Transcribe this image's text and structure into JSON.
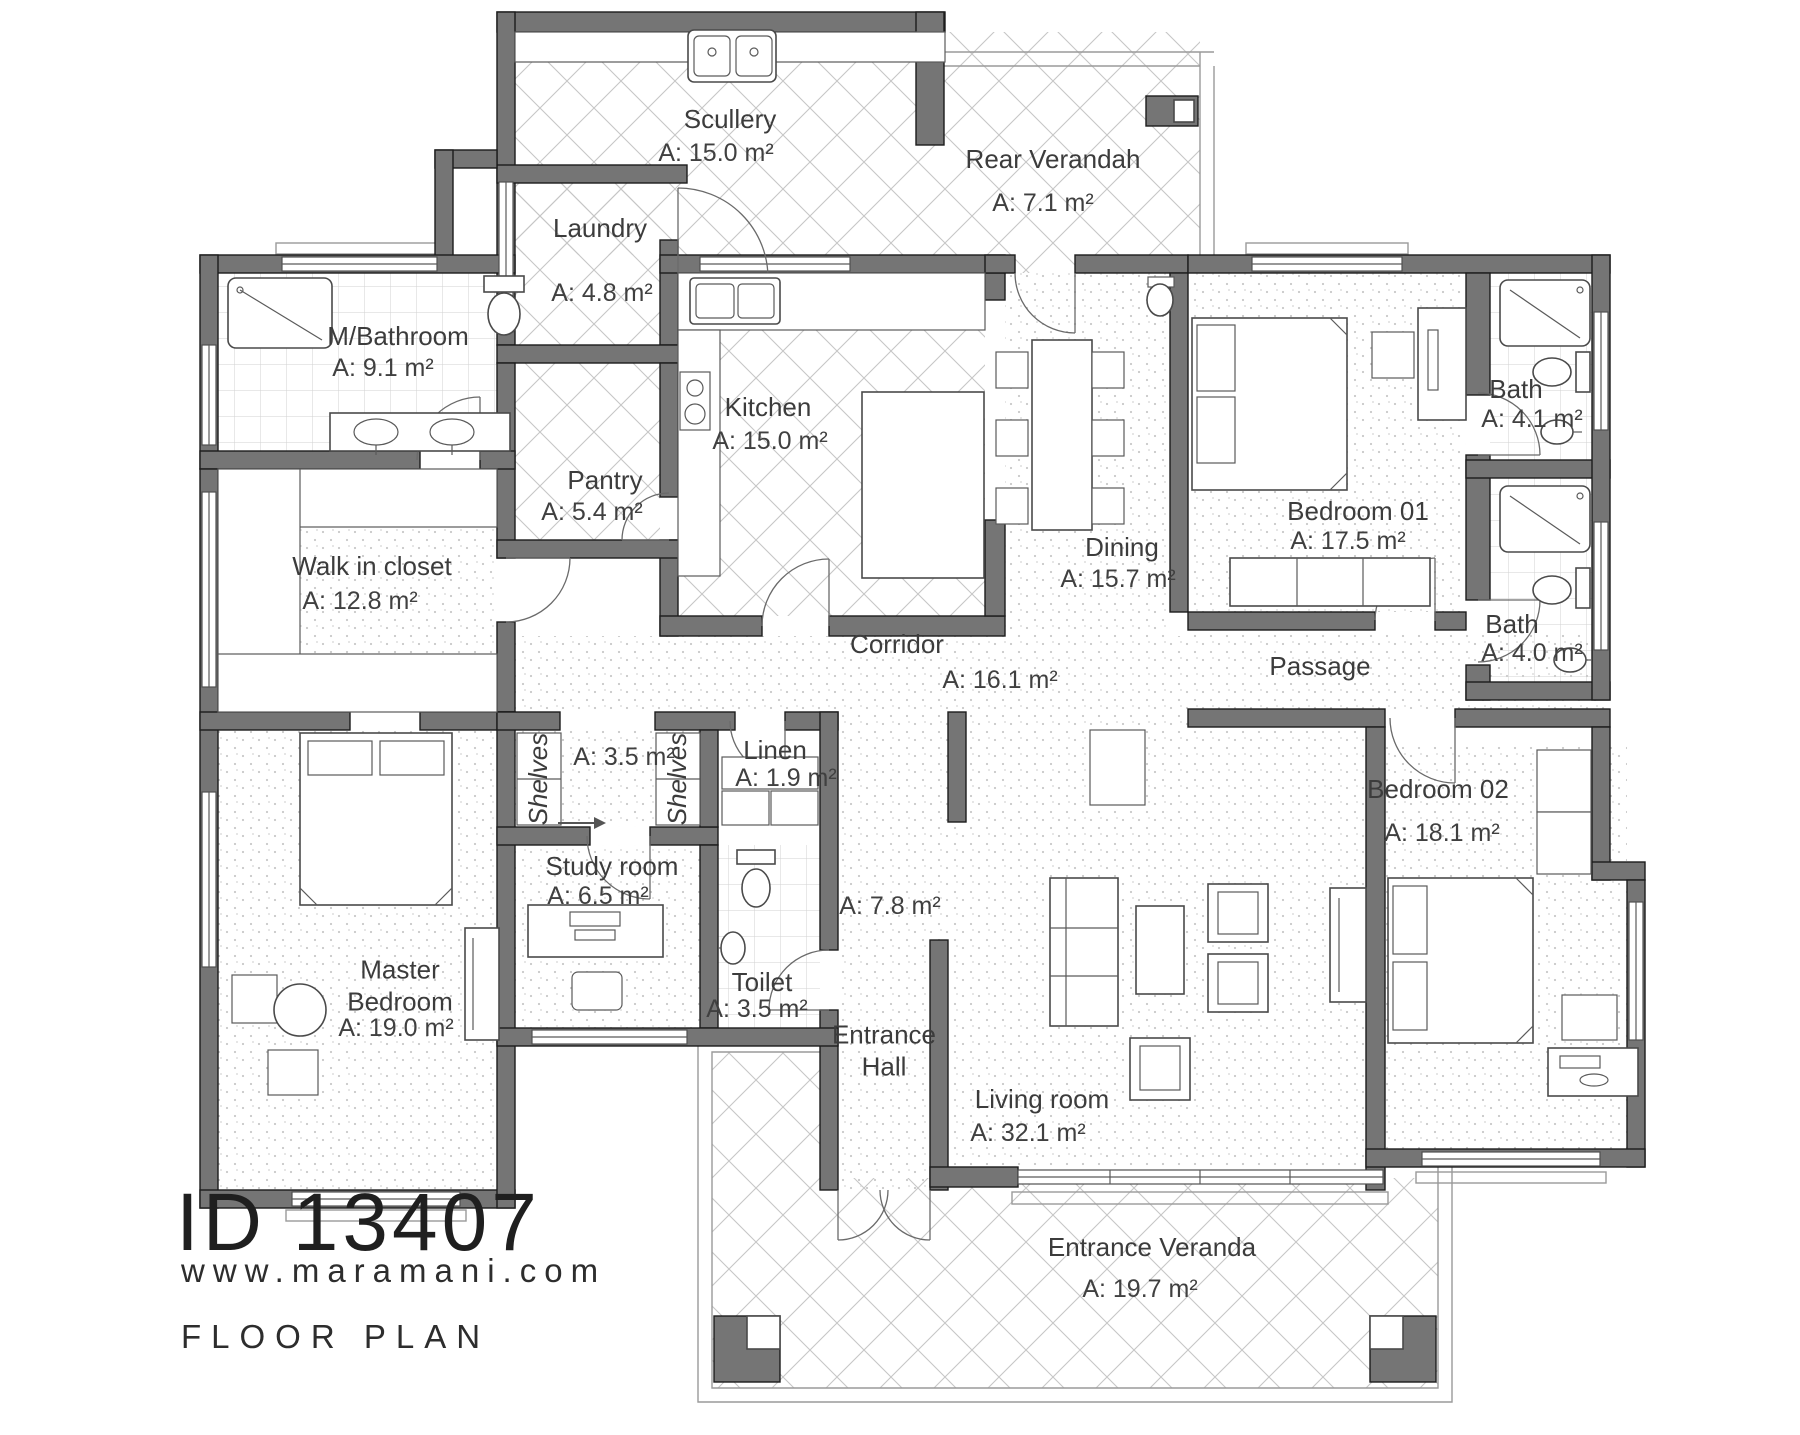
{
  "branding": {
    "plan_id": "ID 13407",
    "website": "www.maramani.com",
    "caption": "FLOOR PLAN"
  },
  "rooms": [
    {
      "key": "scullery",
      "name": "Scullery",
      "area": "A: 15.0 m²"
    },
    {
      "key": "rear-verandah",
      "name": "Rear Verandah",
      "area": "A: 7.1 m²"
    },
    {
      "key": "laundry",
      "name": "Laundry",
      "area": "A: 4.8 m²"
    },
    {
      "key": "m-bathroom",
      "name": "M/Bathroom",
      "area": "A: 9.1 m²"
    },
    {
      "key": "kitchen",
      "name": "Kitchen",
      "area": "A: 15.0 m²"
    },
    {
      "key": "pantry",
      "name": "Pantry",
      "area": "A: 5.4 m²"
    },
    {
      "key": "walk-in-closet",
      "name": "Walk in closet",
      "area": "A: 12.8 m²"
    },
    {
      "key": "dining",
      "name": "Dining",
      "area": "A: 15.7 m²"
    },
    {
      "key": "bedroom-01",
      "name": "Bedroom 01",
      "area": "A: 17.5 m²"
    },
    {
      "key": "bath-1",
      "name": "Bath",
      "area": "A: 4.1 m²"
    },
    {
      "key": "bath-2",
      "name": "Bath",
      "area": "A: 4.0 m²"
    },
    {
      "key": "corridor",
      "name": "Corridor",
      "area": "A: 16.1 m²"
    },
    {
      "key": "passage",
      "name": "Passage",
      "area": ""
    },
    {
      "key": "shelves-left",
      "name": "Shelves",
      "area": ""
    },
    {
      "key": "shelves-right",
      "name": "Shelves",
      "area": ""
    },
    {
      "key": "shelf-passage",
      "name": "",
      "area": "A: 3.5 m²"
    },
    {
      "key": "linen",
      "name": "Linen",
      "area": "A: 1.9 m²"
    },
    {
      "key": "study-room",
      "name": "Study room",
      "area": "A: 6.5 m²"
    },
    {
      "key": "toilet",
      "name": "Toilet",
      "area": "A: 3.5 m²"
    },
    {
      "key": "master-bedroom",
      "name": "Master Bedroom",
      "area": "A: 19.0 m²"
    },
    {
      "key": "entrance-hall",
      "name": "Entrance Hall",
      "area": "A: 7.8 m²"
    },
    {
      "key": "living-room",
      "name": "Living room",
      "area": "A: 32.1 m²"
    },
    {
      "key": "bedroom-02",
      "name": "Bedroom 02",
      "area": "A: 18.1 m²"
    },
    {
      "key": "entrance-veranda",
      "name": "Entrance Veranda",
      "area": "A: 19.7 m²"
    }
  ]
}
